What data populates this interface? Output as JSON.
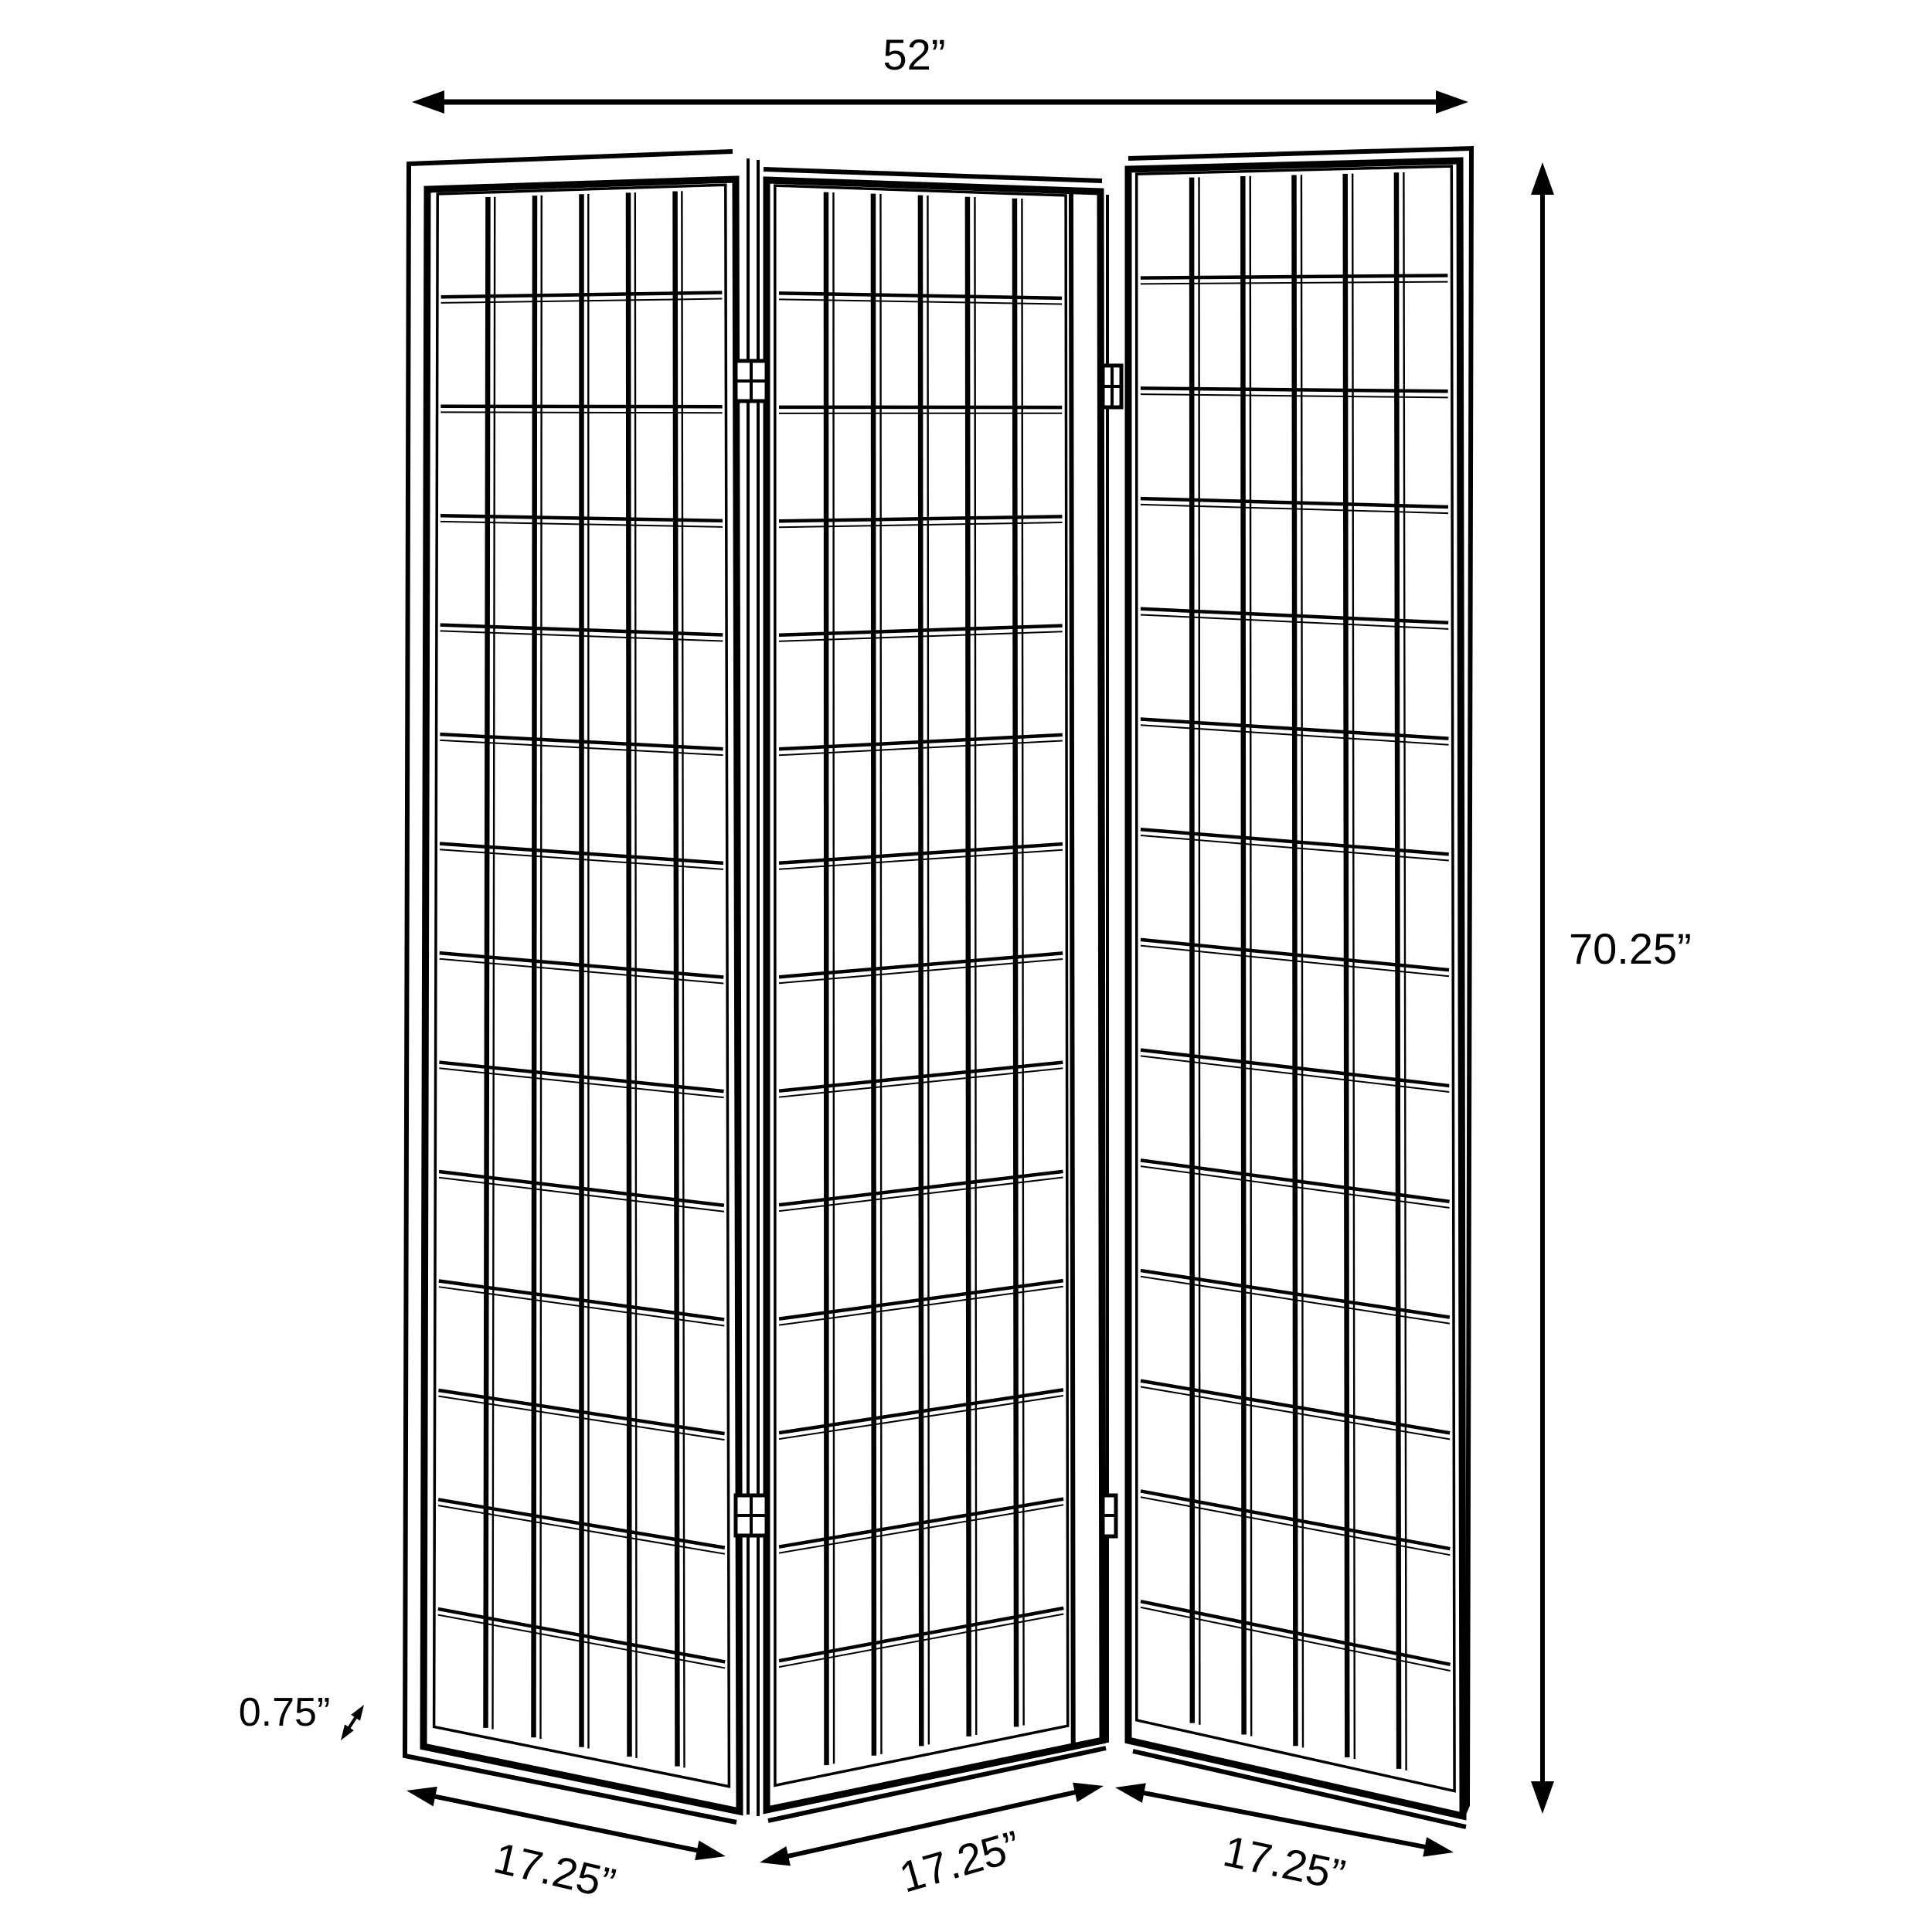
{
  "diagram": {
    "kind": "product dimension line drawing",
    "subject": "3-panel folding screen room divider (shoji window-pane style)",
    "panel_count": 3,
    "panel_grid": {
      "columns": 6,
      "rows": 14
    },
    "hinges_per_junction": 2
  },
  "dimensions": {
    "total_width": "52”",
    "height": "70.25”",
    "panel_width_left": "17.25”",
    "panel_width_middle": "17.25”",
    "panel_width_right": "17.25”",
    "frame_thickness": "0.75”"
  },
  "colors": {
    "line": "#000000",
    "background": "#ffffff"
  }
}
